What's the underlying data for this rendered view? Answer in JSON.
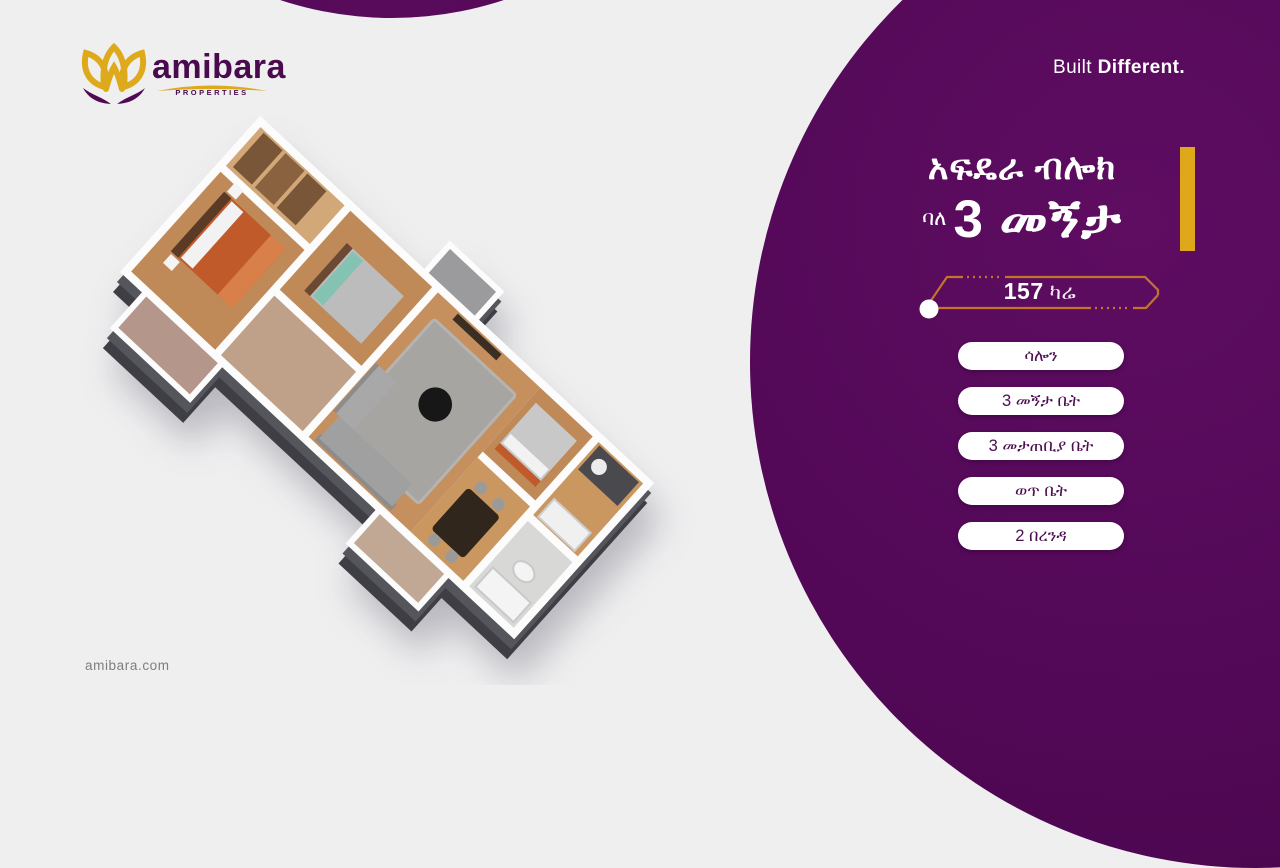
{
  "brand": {
    "name": "amibara",
    "tagline_small": "PROPERTIES",
    "website": "amibara.com"
  },
  "header": {
    "slogan_regular": "Built ",
    "slogan_bold": "Different."
  },
  "listing": {
    "block_title": "አፍዴራ ብሎክ",
    "unit_prefix": "ባለ",
    "unit_title": "3 መኝታ",
    "area_value": "157",
    "area_unit": "ካሬ"
  },
  "features": [
    "ሳሎን",
    "3 መኝታ ቤት",
    "3 መታጠቢያ ቤት",
    "ወጥ ቤት",
    "2 በረንዳ"
  ],
  "colors": {
    "brand_purple": "#540857",
    "brand_gold": "#DFA81C",
    "badge_copper": "#C2742C",
    "pill_text": "#4C0C50",
    "background": "#EFEFF0",
    "plinth_dark": "#3E3E44",
    "wood_floor": "#C08A58"
  }
}
